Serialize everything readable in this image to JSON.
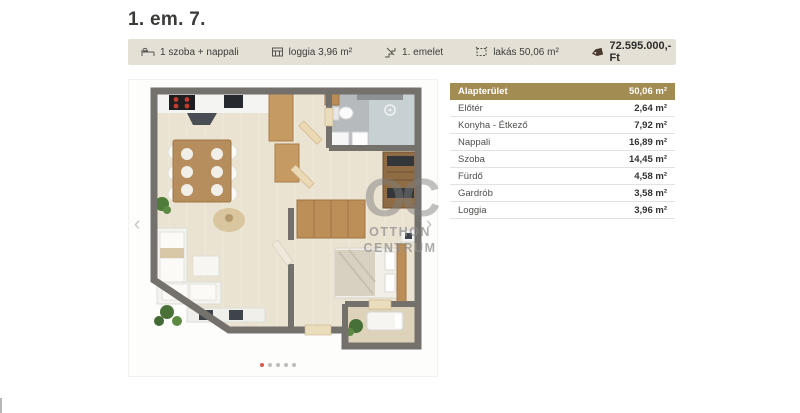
{
  "page": {
    "title": "1. em. 7."
  },
  "infobar": {
    "items": [
      {
        "icon": "rooms-icon",
        "label": "1 szoba + nappali"
      },
      {
        "icon": "loggia-icon",
        "label": "loggia 3,96 m²"
      },
      {
        "icon": "floor-icon",
        "label": "1. emelet"
      },
      {
        "icon": "area-icon",
        "label": "lakás 50,06 m²"
      }
    ],
    "price": {
      "icon": "price-tag-icon",
      "label": "72.595.000,- Ft"
    }
  },
  "gallery": {
    "prev_label": "‹",
    "next_label": "›",
    "dots": {
      "count": 5,
      "active_index": 0
    },
    "watermark": {
      "monogram": "OC",
      "line1": "OTTHON",
      "line2": "CENTRUM"
    }
  },
  "table": {
    "header": {
      "label": "Alapterület",
      "value": "50,06 m²"
    },
    "rows": [
      {
        "label": "Előtér",
        "value": "2,64 m²"
      },
      {
        "label": "Konyha - Étkező",
        "value": "7,92 m²"
      },
      {
        "label": "Nappali",
        "value": "16,89 m²"
      },
      {
        "label": "Szoba",
        "value": "14,45 m²"
      },
      {
        "label": "Fürdő",
        "value": "4,58 m²"
      },
      {
        "label": "Gardrób",
        "value": "3,58 m²"
      },
      {
        "label": "Loggia",
        "value": "3,96 m²"
      }
    ]
  },
  "colors": {
    "table_header_bg": "#a28c52",
    "infobar_bg": "#e4e0d6",
    "active_dot": "#d95b4d",
    "price_tag": "#4a392f",
    "walls": "#74706c"
  }
}
